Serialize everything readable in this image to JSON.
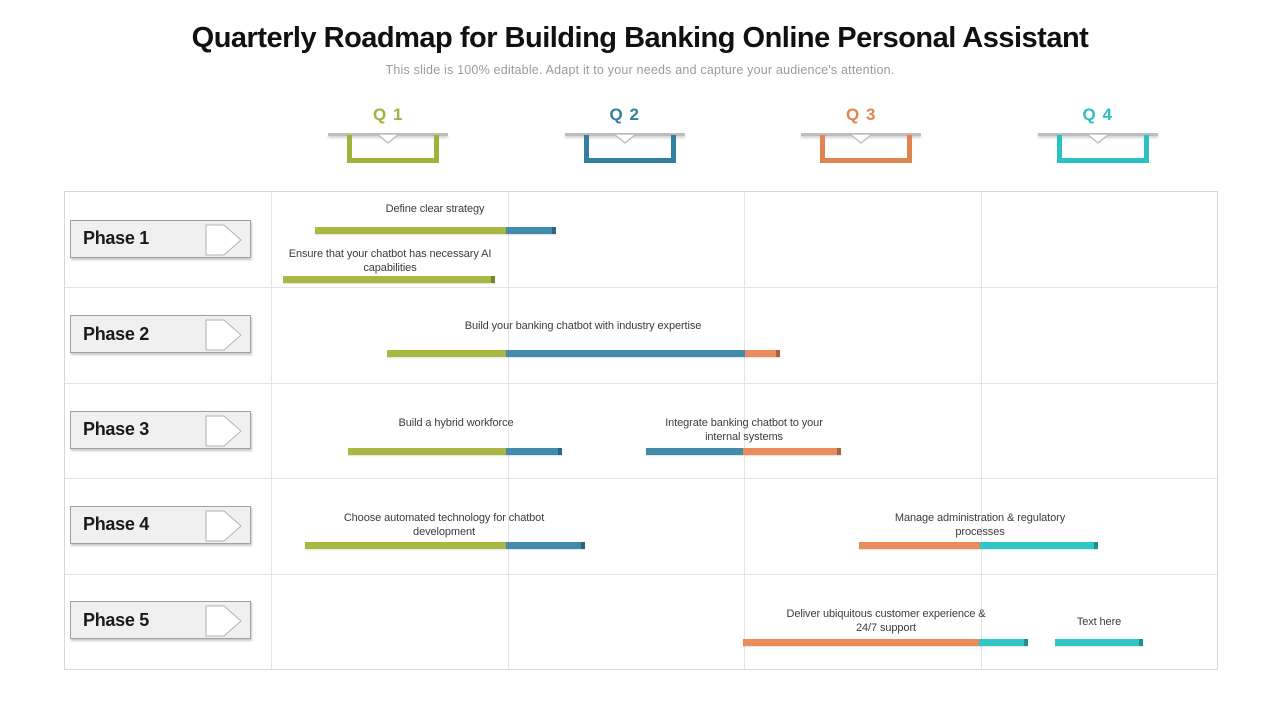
{
  "slide": {
    "title": "Quarterly Roadmap for Building Banking Online Personal Assistant",
    "subtitle": "This slide is 100% editable. Adapt it to your needs and capture your audience's attention."
  },
  "quarters": [
    {
      "label": "Q 1",
      "color": "#a2b13b"
    },
    {
      "label": "Q 2",
      "color": "#337f9e"
    },
    {
      "label": "Q 3",
      "color": "#e0854f"
    },
    {
      "label": "Q 4",
      "color": "#2bc0c2"
    }
  ],
  "phases": [
    {
      "label": "Phase 1"
    },
    {
      "label": "Phase 2"
    },
    {
      "label": "Phase 3"
    },
    {
      "label": "Phase 4"
    },
    {
      "label": "Phase 5"
    }
  ],
  "bar_colors": {
    "green": "#a9b840",
    "blue": "#418cab",
    "orange": "#ec8b5c",
    "teal": "#2fc6c6"
  },
  "chart_data": {
    "type": "gantt-roadmap",
    "columns": [
      "Q 1",
      "Q 2",
      "Q 3",
      "Q 4"
    ],
    "tasks": [
      {
        "phase": 1,
        "label": "Define clear strategy",
        "label_cx": 435,
        "label_top": 202,
        "label_w": 240,
        "bar_top": 227,
        "segments": [
          {
            "color": "green",
            "x": 315,
            "w": 191
          },
          {
            "color": "blue",
            "x": 506,
            "w": 50
          }
        ]
      },
      {
        "phase": 1,
        "label": "Ensure that your chatbot has necessary AI capabilities",
        "label_cx": 390,
        "label_top": 247,
        "label_w": 230,
        "bar_top": 276,
        "segments": [
          {
            "color": "green",
            "x": 283,
            "w": 212
          }
        ]
      },
      {
        "phase": 2,
        "label": "Build your banking chatbot with industry expertise",
        "label_cx": 583,
        "label_top": 319,
        "label_w": 330,
        "bar_top": 350,
        "segments": [
          {
            "color": "green",
            "x": 387,
            "w": 119
          },
          {
            "color": "blue",
            "x": 506,
            "w": 239
          },
          {
            "color": "orange",
            "x": 745,
            "w": 35
          }
        ]
      },
      {
        "phase": 3,
        "label": "Build a hybrid workforce",
        "label_cx": 456,
        "label_top": 416,
        "label_w": 120,
        "bar_top": 448,
        "segments": [
          {
            "color": "green",
            "x": 348,
            "w": 158
          },
          {
            "color": "blue",
            "x": 506,
            "w": 56
          }
        ]
      },
      {
        "phase": 3,
        "label": "Integrate banking chatbot to your internal systems",
        "label_cx": 744,
        "label_top": 416,
        "label_w": 185,
        "bar_top": 448,
        "segments": [
          {
            "color": "blue",
            "x": 646,
            "w": 97
          },
          {
            "color": "orange",
            "x": 743,
            "w": 98
          }
        ]
      },
      {
        "phase": 4,
        "label": "Choose automated technology for chatbot development",
        "label_cx": 444,
        "label_top": 511,
        "label_w": 225,
        "bar_top": 542,
        "segments": [
          {
            "color": "green",
            "x": 305,
            "w": 201
          },
          {
            "color": "blue",
            "x": 506,
            "w": 79
          }
        ]
      },
      {
        "phase": 4,
        "label": "Manage administration & regulatory processes",
        "label_cx": 980,
        "label_top": 511,
        "label_w": 205,
        "bar_top": 542,
        "segments": [
          {
            "color": "orange",
            "x": 859,
            "w": 121
          },
          {
            "color": "teal",
            "x": 980,
            "w": 118
          }
        ]
      },
      {
        "phase": 5,
        "label": "Deliver ubiquitous customer experience & 24/7 support",
        "label_cx": 886,
        "label_top": 607,
        "label_w": 200,
        "bar_top": 639,
        "segments": [
          {
            "color": "orange",
            "x": 743,
            "w": 236
          },
          {
            "color": "teal",
            "x": 979,
            "w": 49
          }
        ]
      },
      {
        "phase": 5,
        "label": "Text here",
        "label_cx": 1099,
        "label_top": 615,
        "label_w": 100,
        "bar_top": 639,
        "segments": [
          {
            "color": "teal",
            "x": 1055,
            "w": 88
          }
        ]
      }
    ]
  }
}
